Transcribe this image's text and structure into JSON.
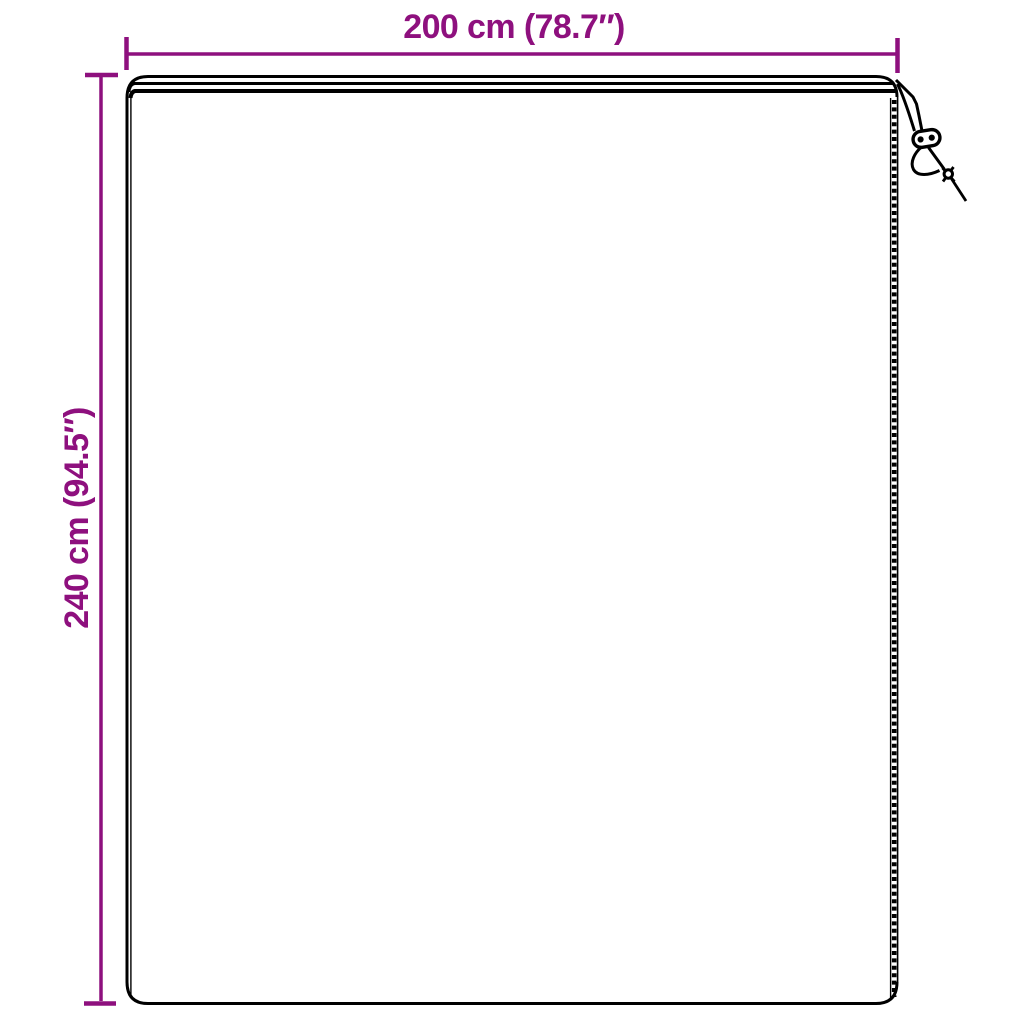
{
  "figure": {
    "labels": {
      "width": "200 cm (78.7″)",
      "height": "240 cm (94.5″)"
    },
    "measurements": {
      "width_cm": 200,
      "width_in": 78.7,
      "height_cm": 240,
      "height_in": 94.5
    },
    "icons": {
      "drawstring": "drawstring-toggle-icon"
    },
    "colors": {
      "accent": "#8E107E",
      "line": "#000000",
      "background": "#FFFFFF"
    }
  }
}
